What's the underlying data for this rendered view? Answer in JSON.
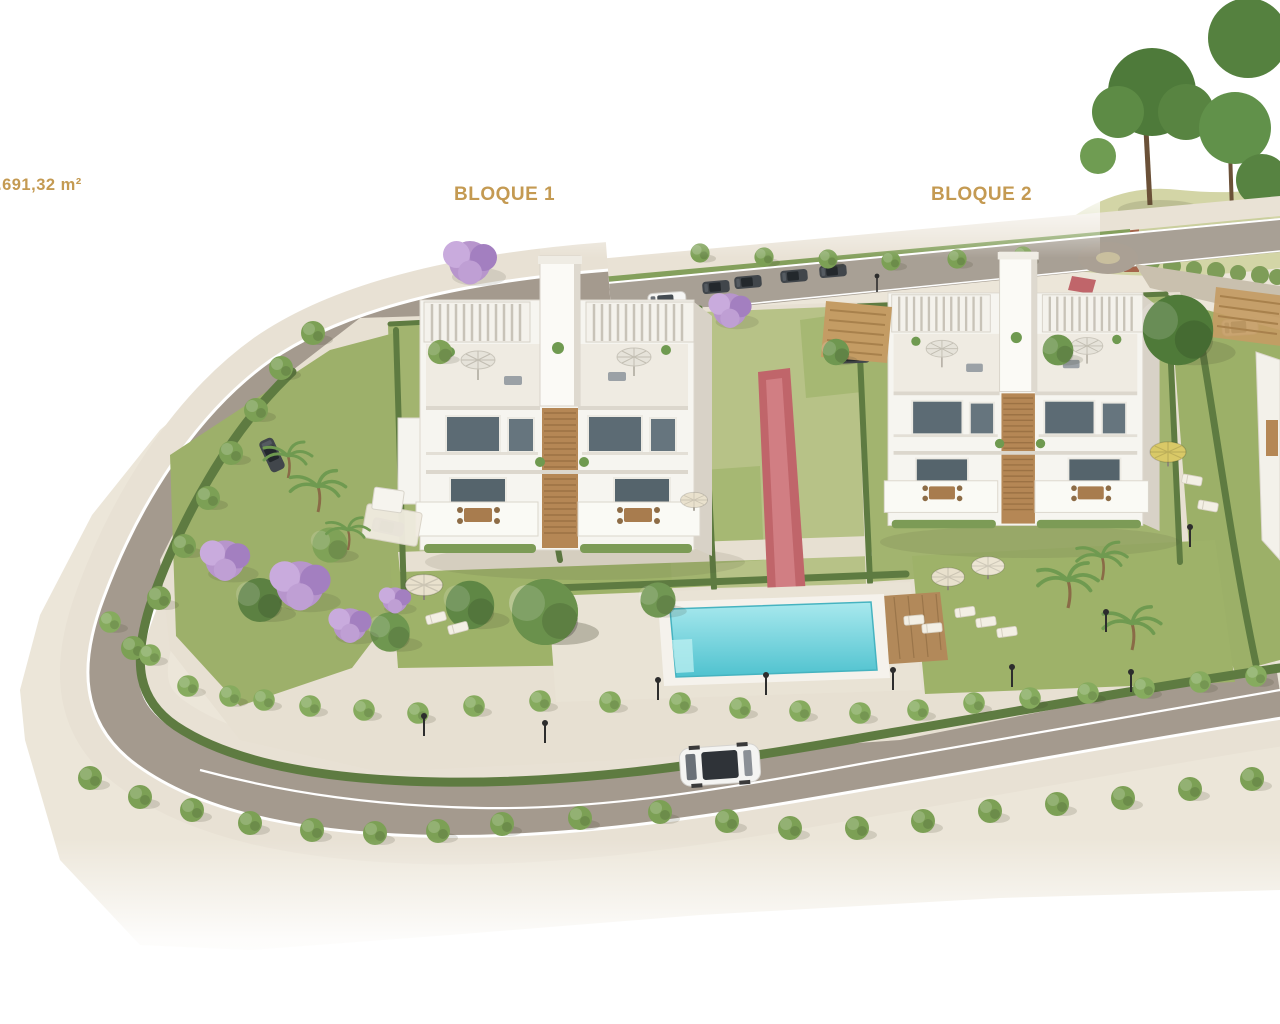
{
  "page": {
    "background": "#ffffff"
  },
  "labels": {
    "area": ".691,32 m²",
    "block1": "BLOQUE 1",
    "block2": "BLOQUE 2"
  },
  "colors": {
    "label_gold": "#c49a52",
    "road_gray": "#a49a8e",
    "sidewalk_beige": "#e8e1d4",
    "lawn_green": "#a2b46f",
    "hedge_green": "#5e7b41",
    "pool_water": "#5ac8d3",
    "path_red": "#c0656a",
    "wood_brown": "#b58755",
    "building_white": "#f6f5f0",
    "tree_green": "#7ca055",
    "jacaranda_purple": "#b795cc",
    "chimney_brick": "#a5654b"
  },
  "scene": {
    "type": "aerial-3d-architectural-render",
    "objects": [
      "apartment block BLOQUE 1",
      "apartment block BLOQUE 2",
      "communal swimming pool",
      "red pedestrian path",
      "perimeter road with street trees",
      "upper road with parked cars",
      "jacaranda trees",
      "palm trees",
      "sun umbrellas and loungers",
      "carports with cars",
      "brick chimney landmark",
      "street lamps"
    ]
  }
}
